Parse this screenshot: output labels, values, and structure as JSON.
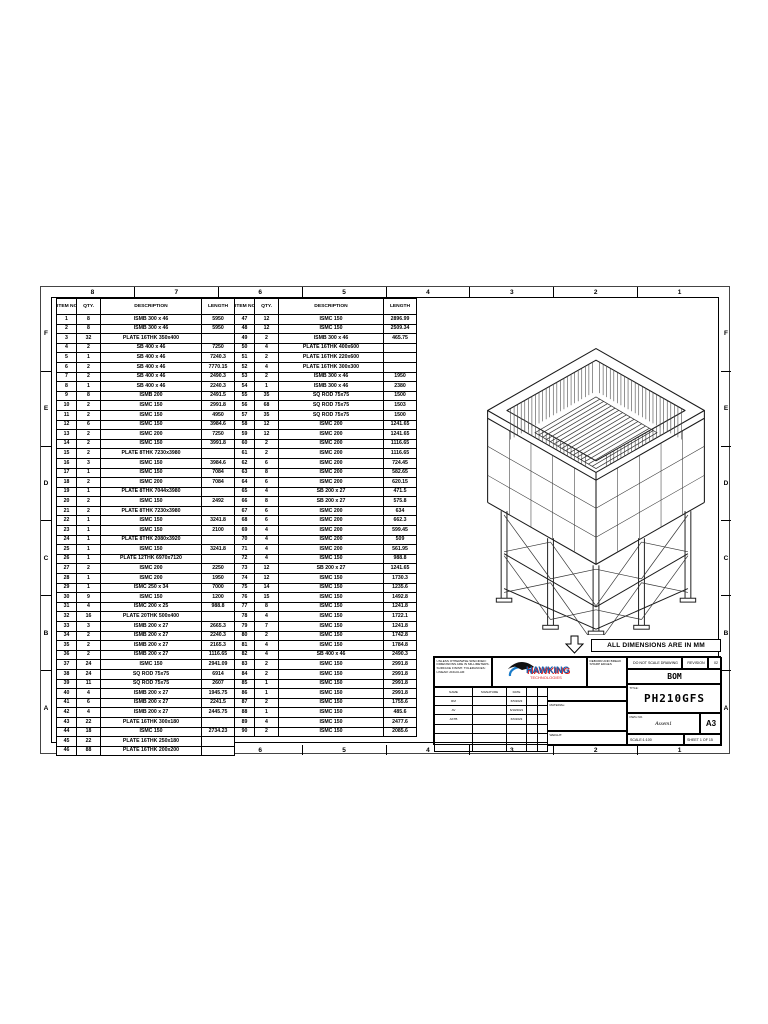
{
  "sheet": {
    "zones_top": [
      "8",
      "7",
      "6",
      "5",
      "4",
      "3",
      "2",
      "1"
    ],
    "zones_bottom": [
      "8",
      "7",
      "6",
      "5",
      "4",
      "3",
      "2",
      "1"
    ],
    "zones_left": [
      "F",
      "E",
      "D",
      "C",
      "B",
      "A"
    ],
    "zones_right": [
      "F",
      "E",
      "D",
      "C",
      "B",
      "A"
    ]
  },
  "bom": {
    "headers": {
      "item": "ITEM NO.",
      "qty": "QTY.",
      "desc": "DESCRIPTION",
      "length": "LENGTH"
    },
    "left_rows": [
      [
        "1",
        "8",
        "ISMB 300 x 46",
        "5950"
      ],
      [
        "2",
        "8",
        "ISMB 300 x 46",
        "5950"
      ],
      [
        "3",
        "32",
        "PLATE 16THK 350x400",
        ""
      ],
      [
        "4",
        "2",
        "SB 400 x 46",
        "7250"
      ],
      [
        "5",
        "1",
        "SB 400 x 46",
        "7240.3"
      ],
      [
        "6",
        "2",
        "SB 400 x 46",
        "7770.15"
      ],
      [
        "7",
        "2",
        "SB 400 x 46",
        "2490.3"
      ],
      [
        "8",
        "1",
        "SB 400 x 46",
        "2240.3"
      ],
      [
        "9",
        "8",
        "ISMB 200",
        "2491.5"
      ],
      [
        "10",
        "2",
        "ISMC 150",
        "2991.8"
      ],
      [
        "11",
        "2",
        "ISMC 150",
        "4950"
      ],
      [
        "12",
        "6",
        "ISMC 150",
        "3984.6"
      ],
      [
        "13",
        "2",
        "ISMC 200",
        "7250"
      ],
      [
        "14",
        "2",
        "ISMC 150",
        "3991.8"
      ],
      [
        "15",
        "2",
        "PLATE 8THK 7230x3980",
        ""
      ],
      [
        "16",
        "3",
        "ISMC 150",
        "3984.6"
      ],
      [
        "17",
        "1",
        "ISMC 150",
        "7084"
      ],
      [
        "18",
        "2",
        "ISMC 200",
        "7084"
      ],
      [
        "19",
        "1",
        "PLATE 8THK 7044x3980",
        ""
      ],
      [
        "20",
        "2",
        "ISMC 150",
        "2492"
      ],
      [
        "21",
        "2",
        "PLATE 8THK 7230x3980",
        ""
      ],
      [
        "22",
        "1",
        "ISMC 150",
        "3241.8"
      ],
      [
        "23",
        "1",
        "ISMC 150",
        "2100"
      ],
      [
        "24",
        "1",
        "PLATE 8THK 2080x3920",
        ""
      ],
      [
        "25",
        "1",
        "ISMC 150",
        "3241.8"
      ],
      [
        "26",
        "1",
        "PLATE 12THK 6970x7120",
        ""
      ],
      [
        "27",
        "2",
        "ISMC 200",
        "2250"
      ],
      [
        "28",
        "1",
        "ISMC 200",
        "1950"
      ],
      [
        "29",
        "1",
        "ISMC 250 x 34",
        "7000"
      ],
      [
        "30",
        "9",
        "ISMC 150",
        "1200"
      ],
      [
        "31",
        "4",
        "ISMC 200 x 25",
        "988.8"
      ],
      [
        "32",
        "16",
        "PLATE 20THK 500x400",
        ""
      ],
      [
        "33",
        "3",
        "ISMB 200 x 27",
        "2665.3"
      ],
      [
        "34",
        "2",
        "ISMB 200 x 27",
        "2240.3"
      ],
      [
        "35",
        "2",
        "ISMB 200 x 27",
        "2165.3"
      ],
      [
        "36",
        "2",
        "ISMB 200 x 27",
        "1116.65"
      ],
      [
        "37",
        "24",
        "ISMC 150",
        "2941.09"
      ],
      [
        "38",
        "24",
        "SQ ROD 75x75",
        "6914"
      ],
      [
        "39",
        "11",
        "SQ ROD 75x75",
        "2607"
      ],
      [
        "40",
        "4",
        "ISMB 200 x 27",
        "1945.75"
      ],
      [
        "41",
        "6",
        "ISMB 200 x 27",
        "2241.5"
      ],
      [
        "42",
        "4",
        "ISMB 200 x 27",
        "2445.75"
      ],
      [
        "43",
        "22",
        "PLATE 16THK 300x180",
        ""
      ],
      [
        "44",
        "18",
        "ISMC 150",
        "2734.23"
      ],
      [
        "45",
        "22",
        "PLATE 16THK 250x180",
        ""
      ],
      [
        "46",
        "88",
        "PLATE 16THK 200x200",
        ""
      ]
    ],
    "right_rows": [
      [
        "47",
        "12",
        "ISMC 150",
        "2896.99"
      ],
      [
        "48",
        "12",
        "ISMC 150",
        "2509.34"
      ],
      [
        "49",
        "2",
        "ISMB 300 x 46",
        "465.75"
      ],
      [
        "50",
        "4",
        "PLATE 16THK 400x600",
        ""
      ],
      [
        "51",
        "2",
        "PLATE 16THK 220x600",
        ""
      ],
      [
        "52",
        "4",
        "PLATE 16THK 300x300",
        ""
      ],
      [
        "53",
        "2",
        "ISMB 300 x 46",
        "1950"
      ],
      [
        "54",
        "1",
        "ISMB 300 x 46",
        "2380"
      ],
      [
        "55",
        "35",
        "SQ ROD 75x75",
        "1500"
      ],
      [
        "56",
        "68",
        "SQ ROD 75x75",
        "1503"
      ],
      [
        "57",
        "35",
        "SQ ROD 75x75",
        "1500"
      ],
      [
        "58",
        "12",
        "ISMC 200",
        "1241.65"
      ],
      [
        "59",
        "12",
        "ISMC 200",
        "1241.65"
      ],
      [
        "60",
        "2",
        "ISMC 200",
        "1116.65"
      ],
      [
        "61",
        "2",
        "ISMC 200",
        "1116.65"
      ],
      [
        "62",
        "6",
        "ISMC 200",
        "724.45"
      ],
      [
        "63",
        "8",
        "ISMC 200",
        "582.65"
      ],
      [
        "64",
        "6",
        "ISMC 200",
        "620.15"
      ],
      [
        "65",
        "4",
        "SB 200 x 27",
        "471.5"
      ],
      [
        "66",
        "8",
        "SB 200 x 27",
        "575.8"
      ],
      [
        "67",
        "6",
        "ISMC 200",
        "634"
      ],
      [
        "68",
        "6",
        "ISMC 200",
        "662.3"
      ],
      [
        "69",
        "4",
        "ISMC 200",
        "599.45"
      ],
      [
        "70",
        "4",
        "ISMC 200",
        "509"
      ],
      [
        "71",
        "4",
        "ISMC 200",
        "561.95"
      ],
      [
        "72",
        "4",
        "ISMC 150",
        "988.8"
      ],
      [
        "73",
        "12",
        "SB 200 x 27",
        "1241.65"
      ],
      [
        "74",
        "12",
        "ISMC 150",
        "1730.3"
      ],
      [
        "75",
        "14",
        "ISMC 150",
        "1235.6"
      ],
      [
        "76",
        "15",
        "ISMC 150",
        "1492.8"
      ],
      [
        "77",
        "8",
        "ISMC 150",
        "1241.8"
      ],
      [
        "78",
        "4",
        "ISMC 150",
        "1722.1"
      ],
      [
        "79",
        "7",
        "ISMC 150",
        "1241.8"
      ],
      [
        "80",
        "2",
        "ISMC 150",
        "1742.8"
      ],
      [
        "81",
        "4",
        "ISMC 150",
        "1784.8"
      ],
      [
        "82",
        "4",
        "SB 400 x 46",
        "2490.3"
      ],
      [
        "83",
        "2",
        "ISMC 150",
        "2991.8"
      ],
      [
        "84",
        "2",
        "ISMC 150",
        "2991.8"
      ],
      [
        "85",
        "1",
        "ISMC 150",
        "2991.8"
      ],
      [
        "86",
        "1",
        "ISMC 150",
        "2991.8"
      ],
      [
        "87",
        "2",
        "ISMC 150",
        "1755.6"
      ],
      [
        "88",
        "1",
        "ISMC 150",
        "485.6"
      ],
      [
        "89",
        "4",
        "ISMC 150",
        "2477.6"
      ],
      [
        "90",
        "2",
        "ISMC 150",
        "2085.6"
      ]
    ]
  },
  "banner": {
    "text": "ALL DIMENSIONS ARE IN MM"
  },
  "logo": {
    "name": "HAWKING",
    "sub": "TECHNOLOGIES"
  },
  "title_block": {
    "notes_left": "UNLESS OTHERWISE SPECIFIED: DIMENSIONS ARE IN MILLIMETERS. SURFACE FINISH: TOLERANCES: LINEAR: ANGULAR:",
    "deburr_note": "DEBURR AND BREAK SHARP EDGES",
    "sign_table": {
      "headers": [
        "NAME",
        "SIGNATURE",
        "DATE",
        "",
        ""
      ],
      "rows": [
        [
          "RM",
          "",
          "6/5/2023"
        ],
        [
          "AV",
          "",
          "6/10/2021"
        ],
        [
          "AKTB",
          "",
          "6/6/2023"
        ],
        [
          "",
          "",
          ""
        ],
        [
          "",
          "",
          ""
        ],
        [
          "",
          "",
          ""
        ]
      ]
    },
    "material_label": "MATERIAL:",
    "weight_label": "WEIGHT:",
    "do_not_scale": "DO NOT SCALE DRAWING",
    "revision_label": "REVISION",
    "revision_value": "02",
    "doc_type": "BOM",
    "title_label": "TITLE:",
    "title_value": "PH210GFS",
    "dwg_label": "DWG NO.",
    "dwg_value": "Assem1",
    "paper_size": "A3",
    "scale_text": "SCALE:1:100",
    "sheet_text": "SHEET 1 OF 15"
  }
}
